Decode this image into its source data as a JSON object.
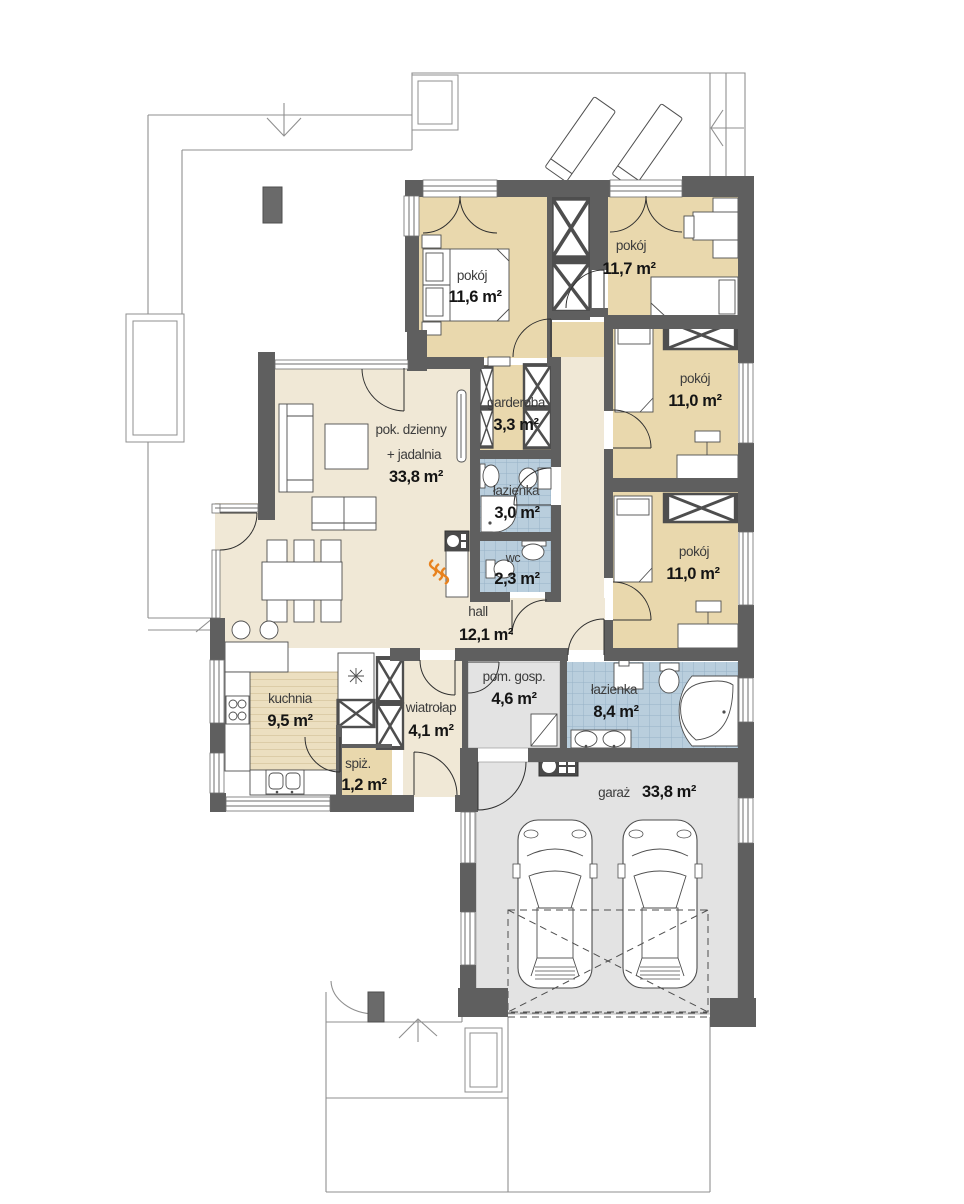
{
  "plan": {
    "type": "floor-plan",
    "rooms": [
      {
        "id": "pokoj-11-6",
        "name": "pokój",
        "area": "11,6 m²"
      },
      {
        "id": "pokoj-11-7",
        "name": "pokój",
        "area": "11,7 m²"
      },
      {
        "id": "pokoj-11-0-a",
        "name": "pokój",
        "area": "11,0 m²"
      },
      {
        "id": "pokoj-11-0-b",
        "name": "pokój",
        "area": "11,0 m²"
      },
      {
        "id": "garderoba",
        "name": "garderoba",
        "area": "3,3 m²"
      },
      {
        "id": "lazienka-mala",
        "name": "łazienka",
        "area": "3,0 m²"
      },
      {
        "id": "wc",
        "name": "wc",
        "area": "2,3 m²"
      },
      {
        "id": "pok-dzienny",
        "name": "pok. dzienny",
        "name2": "+ jadalnia",
        "area": "33,8 m²"
      },
      {
        "id": "hall",
        "name": "hall",
        "area": "12,1 m²"
      },
      {
        "id": "kuchnia",
        "name": "kuchnia",
        "area": "9,5 m²"
      },
      {
        "id": "wiatrolap",
        "name": "wiatrołap",
        "area": "4,1 m²"
      },
      {
        "id": "spiz",
        "name": "spiż.",
        "area": "1,2 m²"
      },
      {
        "id": "pom-gosp",
        "name": "pom. gosp.",
        "area": "4,6 m²"
      },
      {
        "id": "lazienka-duza",
        "name": "łazienka",
        "area": "8,4 m²"
      },
      {
        "id": "garaz",
        "name": "garaż",
        "area": "33,8 m²"
      }
    ],
    "colors": {
      "wall": "#5f5f5f",
      "bedroom_floor": "#e9d8ad",
      "living_floor": "#f0e8d6",
      "tile_floor": "#b9cedd",
      "tile_grid": "#97b2c6",
      "utility_floor": "#e3e3e3",
      "wood_stripe": "#cbb98e",
      "flame_accent": "#e8821e",
      "outline": "#4e4e4e"
    }
  }
}
